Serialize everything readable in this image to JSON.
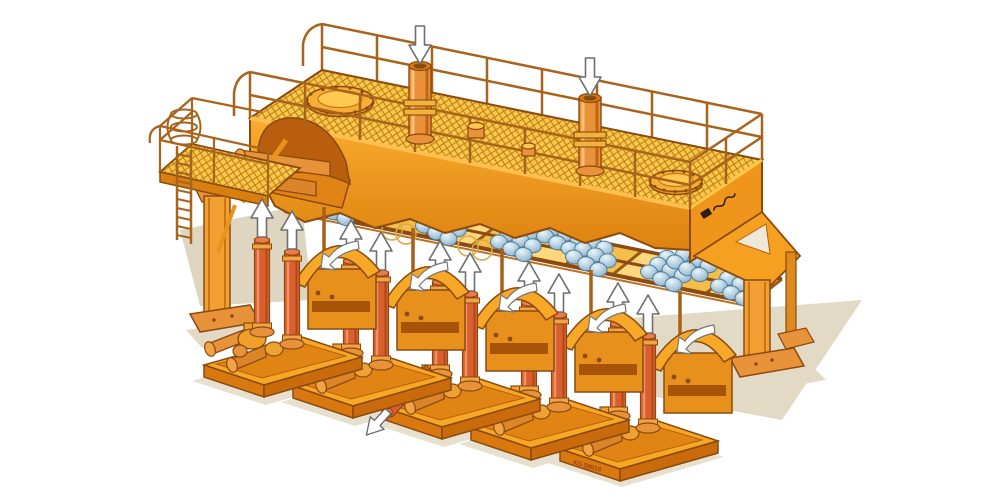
{
  "illustration": {
    "nameplate": {
      "text": "KS 09818"
    },
    "counts": {
      "pump_units": 5,
      "riser_pipes_per_unit": 2,
      "up_arrows": 10,
      "down_arrows": 2,
      "curved_arrows": 5,
      "standpipes": 2,
      "manhole_covers": 2,
      "ball_clusters": 9,
      "support_legs": 3,
      "discharge_pipes": 1
    },
    "colors": {
      "background": "#FFFFFF",
      "body_orange": "#F5A021",
      "body_highlight": "#FFC84A",
      "body_shadow": "#D9780E",
      "deck_mesh_yellow": "#F7C94B",
      "mesh_hatch": "#C07A14",
      "riser_red": "#D95F2E",
      "ball_blue": "#AECBDD",
      "rail_brown": "#A8641C",
      "outline_brown": "#8A4A10",
      "ground_shadow": "#E3DAC6",
      "arrow_fill": "#FFFFFF",
      "arrow_outline": "#6E6E6E"
    },
    "icons": {
      "flow_in": "down-arrow",
      "flow_out": "up-arrow",
      "circulation": "curved-arrow",
      "manhole": "bolted-ellipse",
      "ladder": "caged-ladder"
    }
  }
}
